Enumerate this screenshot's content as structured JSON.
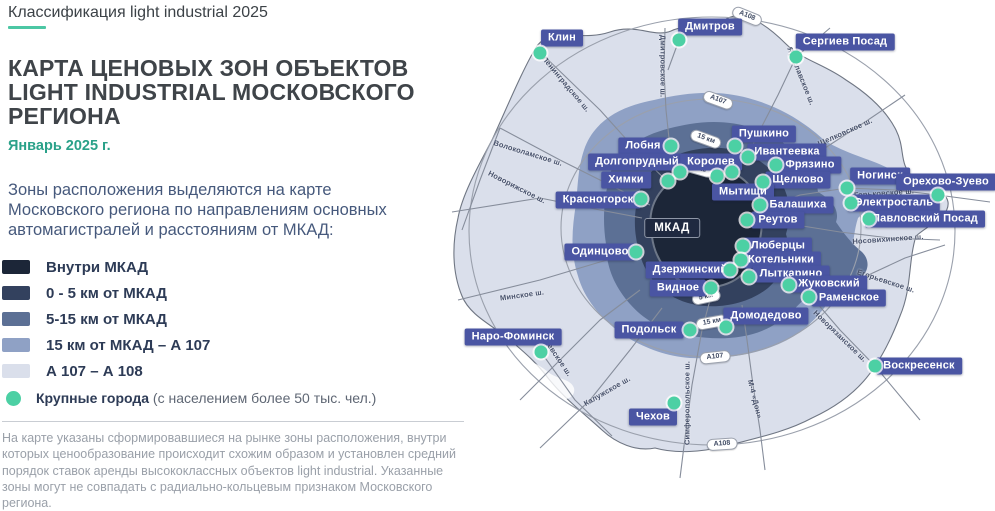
{
  "header": {
    "kicker": "Классификация light industrial 2025"
  },
  "title": "КАРТА ЦЕНОВЫХ ЗОН ОБЪЕКТОВ LIGHT INDUSTRIAL МОСКОВСКОГО РЕГИОНА",
  "date": "Январь 2025 г.",
  "intro": "Зоны расположения выделяются на карте Московского региона по направлениям основных автомагистралей и расстояниям от МКАД:",
  "legend": {
    "zones": [
      {
        "label": "Внутри МКАД",
        "color": "#1c2638"
      },
      {
        "label": "0 - 5 км от МКАД",
        "color": "#33415e"
      },
      {
        "label": "5-15 км от МКАД",
        "color": "#5c7095"
      },
      {
        "label": "15 км от МКАД – А 107",
        "color": "#8fa1c5"
      },
      {
        "label": "А 107 – А 108",
        "color": "#dadfeb"
      }
    ],
    "cities_marker": {
      "label_bold": "Крупные города",
      "label_rest": " (с населением более 50 тыс. чел.)",
      "color": "#4cd0a4"
    }
  },
  "footnote": "На карте указаны сформировавшиеся на рынке зоны расположения, внутри которых ценообразование происходит схожим образом и установлен средний порядок ставок аренды высококлассных объектов light industrial. Указанные зоны могут не совпадать с радиально-кольцевым признаком Московского региона.",
  "map": {
    "center_badge": "МКАД",
    "label_bg": "#4a55a3",
    "road_color": "#8a91a0",
    "cities": [
      {
        "name": "Клин",
        "x": 562,
        "y": 38,
        "dx": 540,
        "dy": 53
      },
      {
        "name": "Дмитров",
        "x": 710,
        "y": 27,
        "dx": 679,
        "dy": 40
      },
      {
        "name": "Сергиев Посад",
        "x": 845,
        "y": 42,
        "dx": 796,
        "dy": 57
      },
      {
        "name": "Лобня",
        "x": 643,
        "y": 146,
        "dx": 671,
        "dy": 146
      },
      {
        "name": "Пушкино",
        "x": 764,
        "y": 134,
        "dx": 735,
        "dy": 146
      },
      {
        "name": "Долгопрудный",
        "x": 637,
        "y": 162,
        "dx": 680,
        "dy": 172
      },
      {
        "name": "Королев",
        "x": 711,
        "y": 162,
        "dx": 717,
        "dy": 176
      },
      {
        "name": "Ивантеевка",
        "x": 787,
        "y": 152,
        "dx": 748,
        "dy": 157
      },
      {
        "name": "Фрязино",
        "x": 810,
        "y": 165,
        "dx": 776,
        "dy": 165
      },
      {
        "name": "Химки",
        "x": 626,
        "y": 180,
        "dx": 668,
        "dy": 181
      },
      {
        "name": "Щелково",
        "x": 798,
        "y": 180,
        "dx": 763,
        "dy": 182
      },
      {
        "name": "Мытищи",
        "x": 743,
        "y": 192,
        "dx": 732,
        "dy": 172
      },
      {
        "name": "Красногорск",
        "x": 598,
        "y": 200,
        "dx": 641,
        "dy": 199
      },
      {
        "name": "Балашиха",
        "x": 798,
        "y": 205,
        "dx": 760,
        "dy": 205
      },
      {
        "name": "Реутов",
        "x": 778,
        "y": 220,
        "dx": 747,
        "dy": 220
      },
      {
        "name": "Ногинск",
        "x": 880,
        "y": 176,
        "dx": 847,
        "dy": 188
      },
      {
        "name": "Орехово-Зуево",
        "x": 946,
        "y": 182,
        "dx": 938,
        "dy": 195
      },
      {
        "name": "Электросталь",
        "x": 894,
        "y": 203,
        "dx": 851,
        "dy": 203
      },
      {
        "name": "Павловский Посад",
        "x": 925,
        "y": 219,
        "dx": 869,
        "dy": 219
      },
      {
        "name": "Одинцово",
        "x": 600,
        "y": 252,
        "dx": 636,
        "dy": 252
      },
      {
        "name": "Люберцы",
        "x": 778,
        "y": 246,
        "dx": 743,
        "dy": 246
      },
      {
        "name": "Котельники",
        "x": 781,
        "y": 260,
        "dx": 741,
        "dy": 260
      },
      {
        "name": "Дзержинский",
        "x": 690,
        "y": 270,
        "dx": 730,
        "dy": 270
      },
      {
        "name": "Лыткарино",
        "x": 791,
        "y": 274,
        "dx": 749,
        "dy": 277
      },
      {
        "name": "Жуковский",
        "x": 829,
        "y": 284,
        "dx": 789,
        "dy": 285
      },
      {
        "name": "Раменское",
        "x": 849,
        "y": 298,
        "dx": 809,
        "dy": 297
      },
      {
        "name": "Видное",
        "x": 678,
        "y": 288,
        "dx": 711,
        "dy": 288
      },
      {
        "name": "Домодедово",
        "x": 766,
        "y": 316,
        "dx": 726,
        "dy": 327
      },
      {
        "name": "Подольск",
        "x": 649,
        "y": 330,
        "dx": 690,
        "dy": 330
      },
      {
        "name": "Наро-Фоминск",
        "x": 513,
        "y": 337,
        "dx": 541,
        "dy": 352
      },
      {
        "name": "Чехов",
        "x": 653,
        "y": 417,
        "dx": 674,
        "dy": 403
      },
      {
        "name": "Воскресенск",
        "x": 919,
        "y": 366,
        "dx": 875,
        "dy": 366
      }
    ],
    "road_labels": [
      {
        "t": "Ленинградское ш.",
        "x": 566,
        "y": 84,
        "r": 50
      },
      {
        "t": "Дмитровское ш.",
        "x": 663,
        "y": 66,
        "r": 90
      },
      {
        "t": "Ярославское ш.",
        "x": 801,
        "y": 76,
        "r": 68
      },
      {
        "t": "Щелковское ш.",
        "x": 845,
        "y": 132,
        "r": -24
      },
      {
        "t": "Горьковское ш.",
        "x": 884,
        "y": 193,
        "r": -4
      },
      {
        "t": "Носовихинское ш.",
        "x": 888,
        "y": 239,
        "r": -4
      },
      {
        "t": "Егорьевское ш.",
        "x": 886,
        "y": 281,
        "r": 18
      },
      {
        "t": "Новорязанское ш.",
        "x": 840,
        "y": 336,
        "r": 44
      },
      {
        "t": "М-4 «Дон»",
        "x": 755,
        "y": 399,
        "r": 76
      },
      {
        "t": "Симферопольское ш.",
        "x": 687,
        "y": 403,
        "r": -90
      },
      {
        "t": "Калужское ш.",
        "x": 607,
        "y": 391,
        "r": -30
      },
      {
        "t": "Киевское ш.",
        "x": 557,
        "y": 356,
        "r": 56
      },
      {
        "t": "Минское ш.",
        "x": 522,
        "y": 295,
        "r": -8
      },
      {
        "t": "Новорижское ш.",
        "x": 517,
        "y": 187,
        "r": 27
      },
      {
        "t": "Волоколамское ш.",
        "x": 528,
        "y": 153,
        "r": 17
      }
    ],
    "road_badges": [
      {
        "t": "А108",
        "x": 747,
        "y": 16,
        "r": 22
      },
      {
        "t": "А107",
        "x": 718,
        "y": 100,
        "r": 20
      },
      {
        "t": "15 км",
        "x": 706,
        "y": 139,
        "r": 20
      },
      {
        "t": "5 км",
        "x": 699,
        "y": 169,
        "r": 16
      },
      {
        "t": "5 км",
        "x": 706,
        "y": 297,
        "r": -12
      },
      {
        "t": "15 км",
        "x": 712,
        "y": 322,
        "r": -10
      },
      {
        "t": "А107",
        "x": 715,
        "y": 357,
        "r": -6
      },
      {
        "t": "А108",
        "x": 722,
        "y": 444,
        "r": -4
      }
    ]
  }
}
